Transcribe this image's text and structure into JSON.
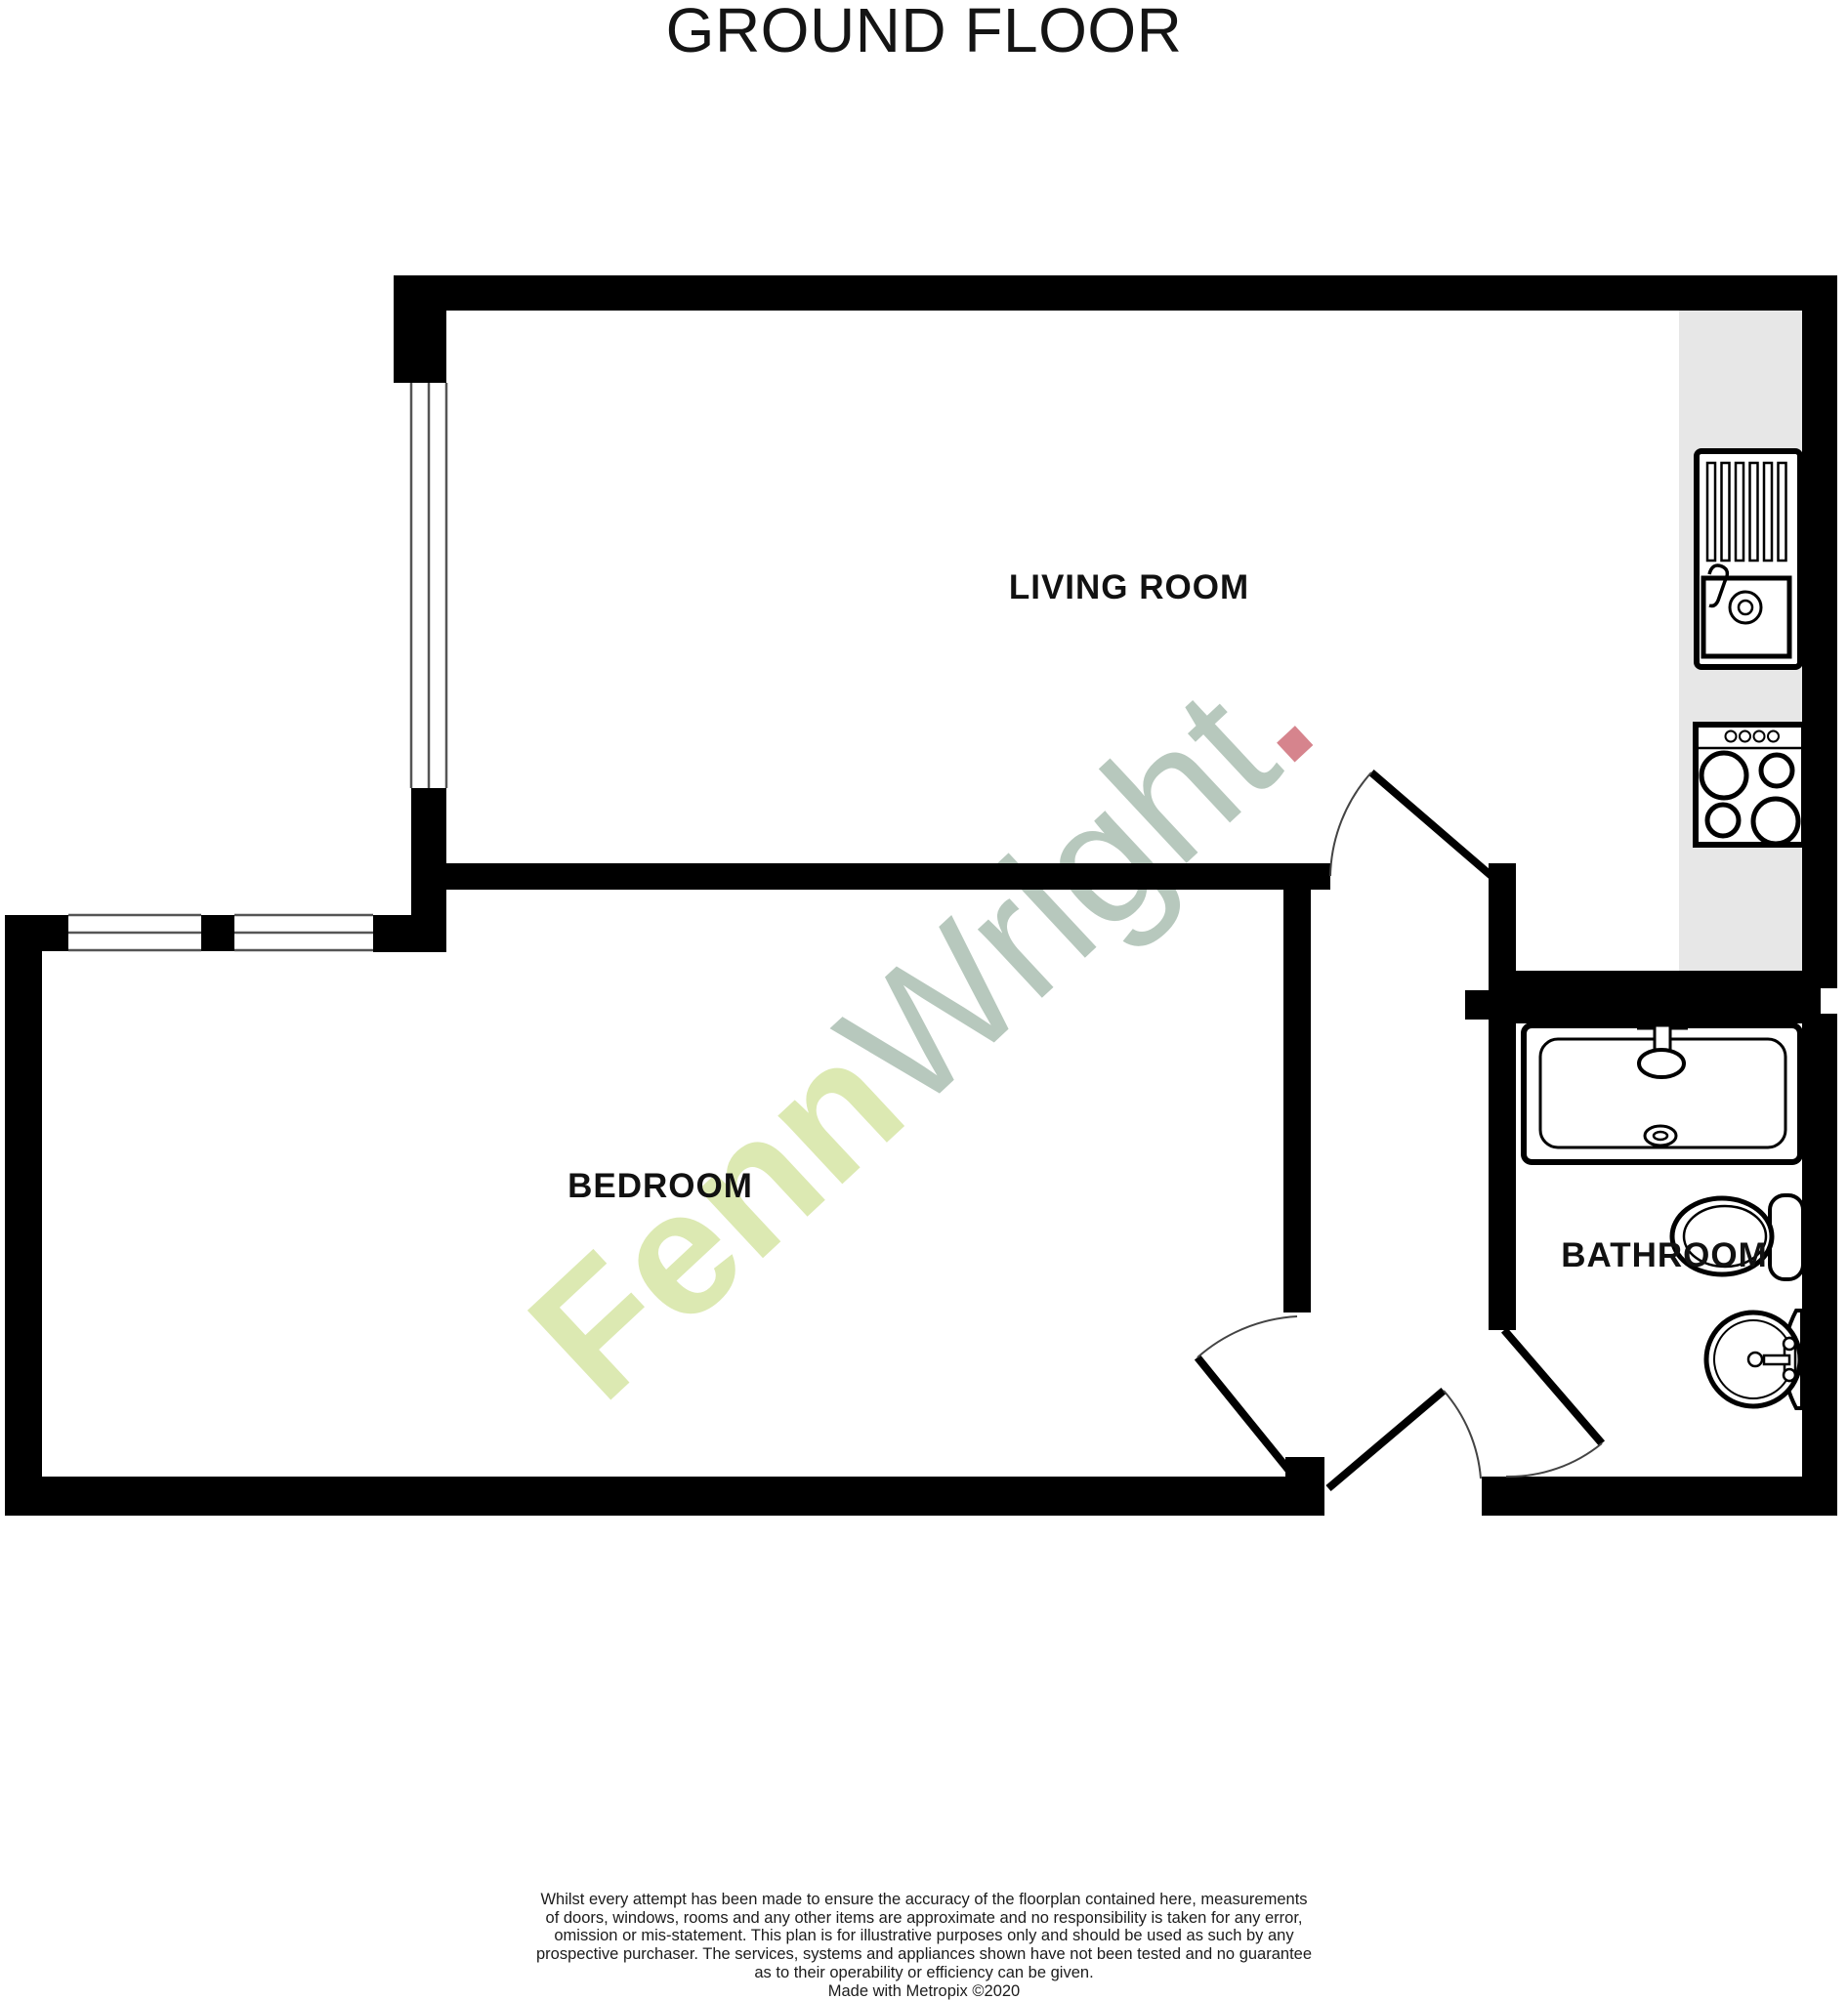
{
  "title": "GROUND FLOOR",
  "rooms": {
    "living": {
      "label": "LIVING ROOM"
    },
    "bedroom": {
      "label": "BEDROOM"
    },
    "bathroom": {
      "label": "BATHROOM"
    }
  },
  "watermark": {
    "fenn": "Fenn",
    "wright": "Wright",
    "dot": "."
  },
  "colors": {
    "wall_black": "#000000",
    "kitchen_worktop_grey": "#e7e7e7",
    "window_line_grey": "#555555",
    "watermark_fenn_green": "#dce9b2",
    "watermark_wright_grey": "#b7c8bd",
    "watermark_dot_red": "#d6848d"
  },
  "disclaimer": {
    "lines": [
      "Whilst every attempt has been made to ensure the accuracy of the floorplan contained here, measurements",
      "of doors, windows, rooms and any other items are approximate and no responsibility is taken for any error,",
      "omission or mis-statement. This plan is for illustrative purposes only and should be used as such by any",
      "prospective purchaser. The services, systems and appliances shown have not been tested and no guarantee",
      "as to their operability or efficiency can be given.",
      "Made with Metropix ©2020"
    ]
  }
}
